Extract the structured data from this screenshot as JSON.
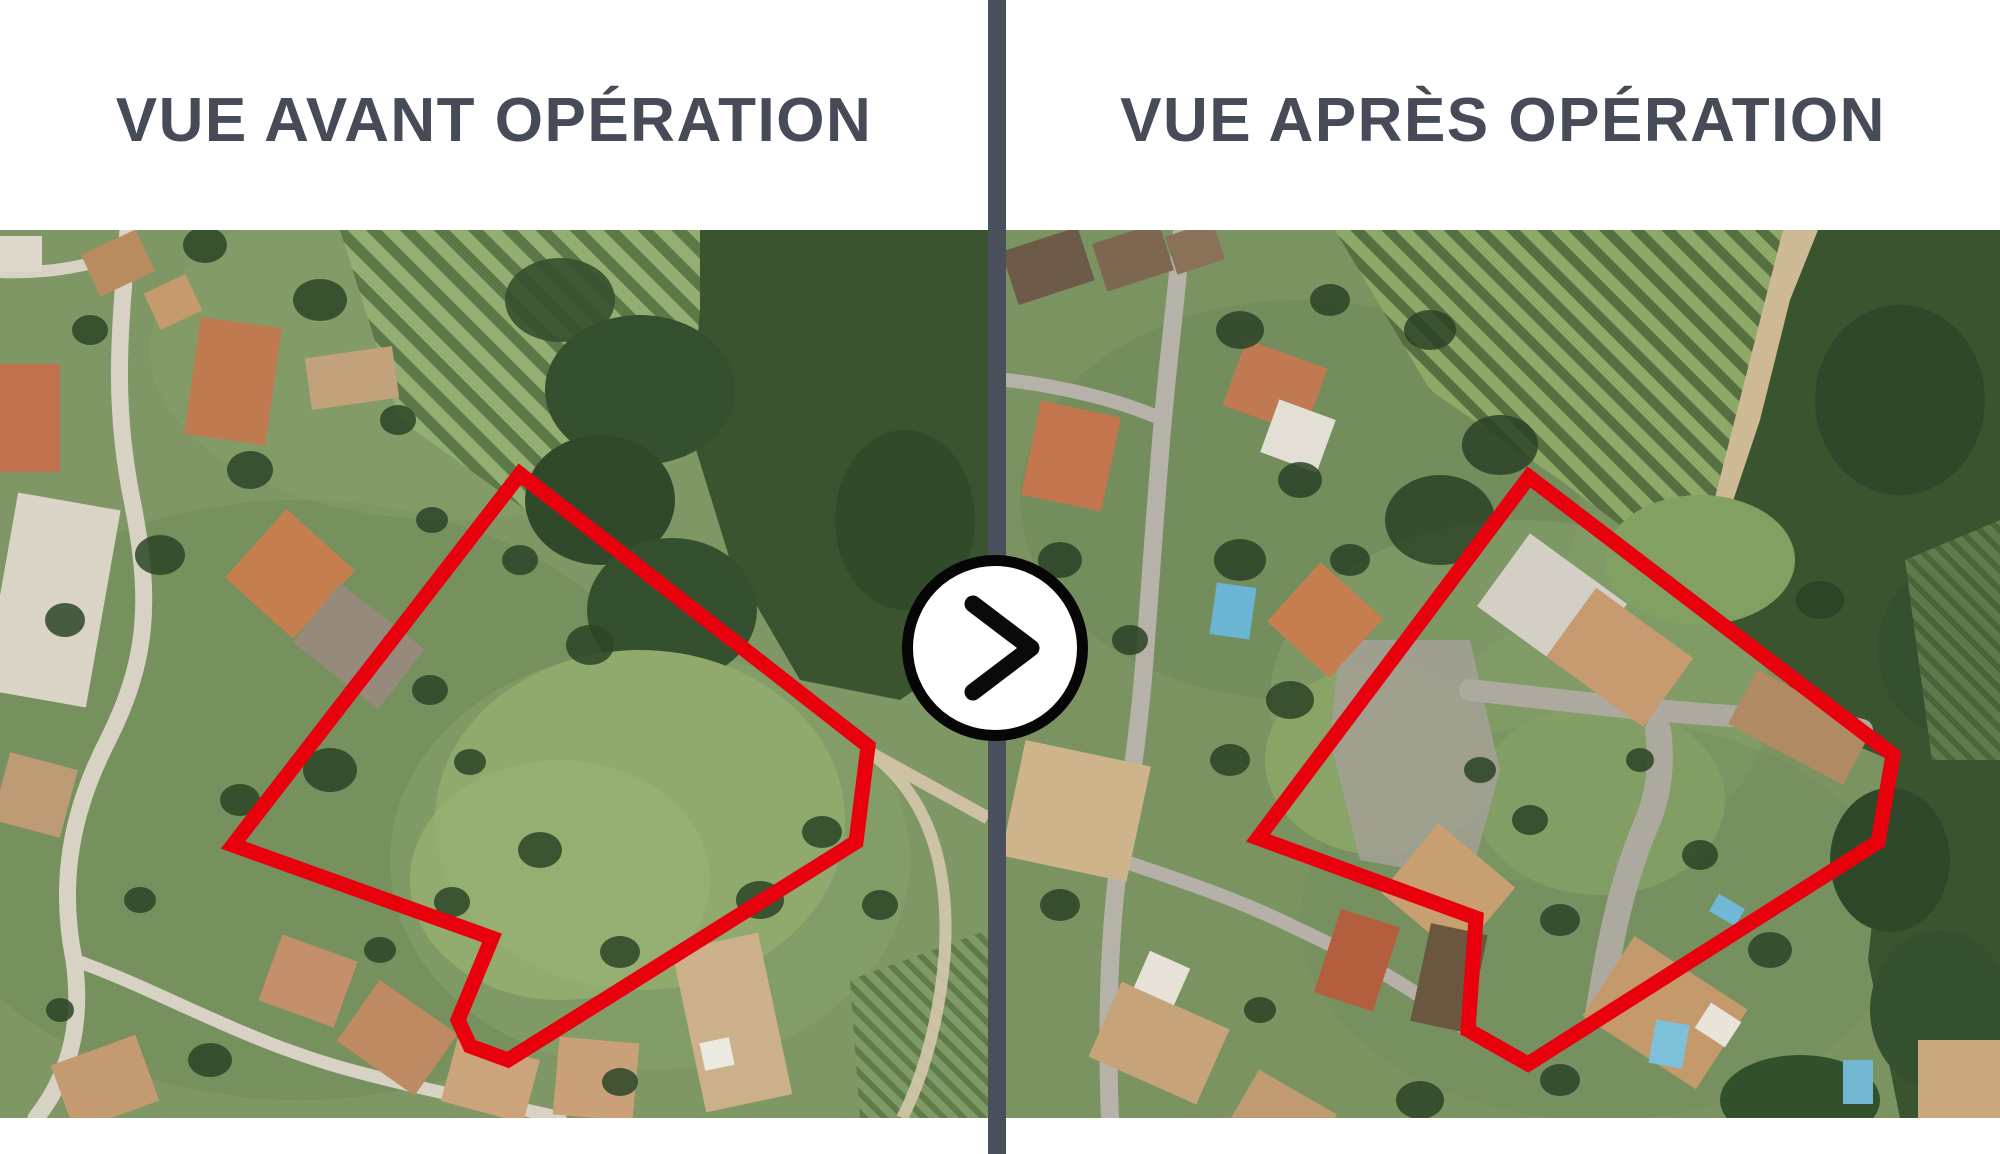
{
  "graphic": {
    "language": "fr",
    "description": "Comparaison aérienne avant/après d'une opération d'aménagement"
  },
  "panels": {
    "before": {
      "title": "VUE AVANT OPÉRATION",
      "parcel_outline_points": "520,474 868,746 856,842 508,1060 470,1046 458,1020 492,938 233,845"
    },
    "after": {
      "title": "VUE APRÈS OPÉRATION",
      "parcel_outline_points": "1529,477 1893,755 1878,842 1528,1064 1468,1030 1476,918 1258,838"
    }
  },
  "arrow_button": {
    "icon": "chevron-right-icon",
    "meaning": "avant vers après"
  },
  "colors": {
    "background": "#ffffff",
    "title_text": "#454b57",
    "divider": "#4a505b",
    "parcel_outline": "#e8000d",
    "arrow_button_bg": "#ffffff",
    "arrow_button_border": "#060606"
  }
}
